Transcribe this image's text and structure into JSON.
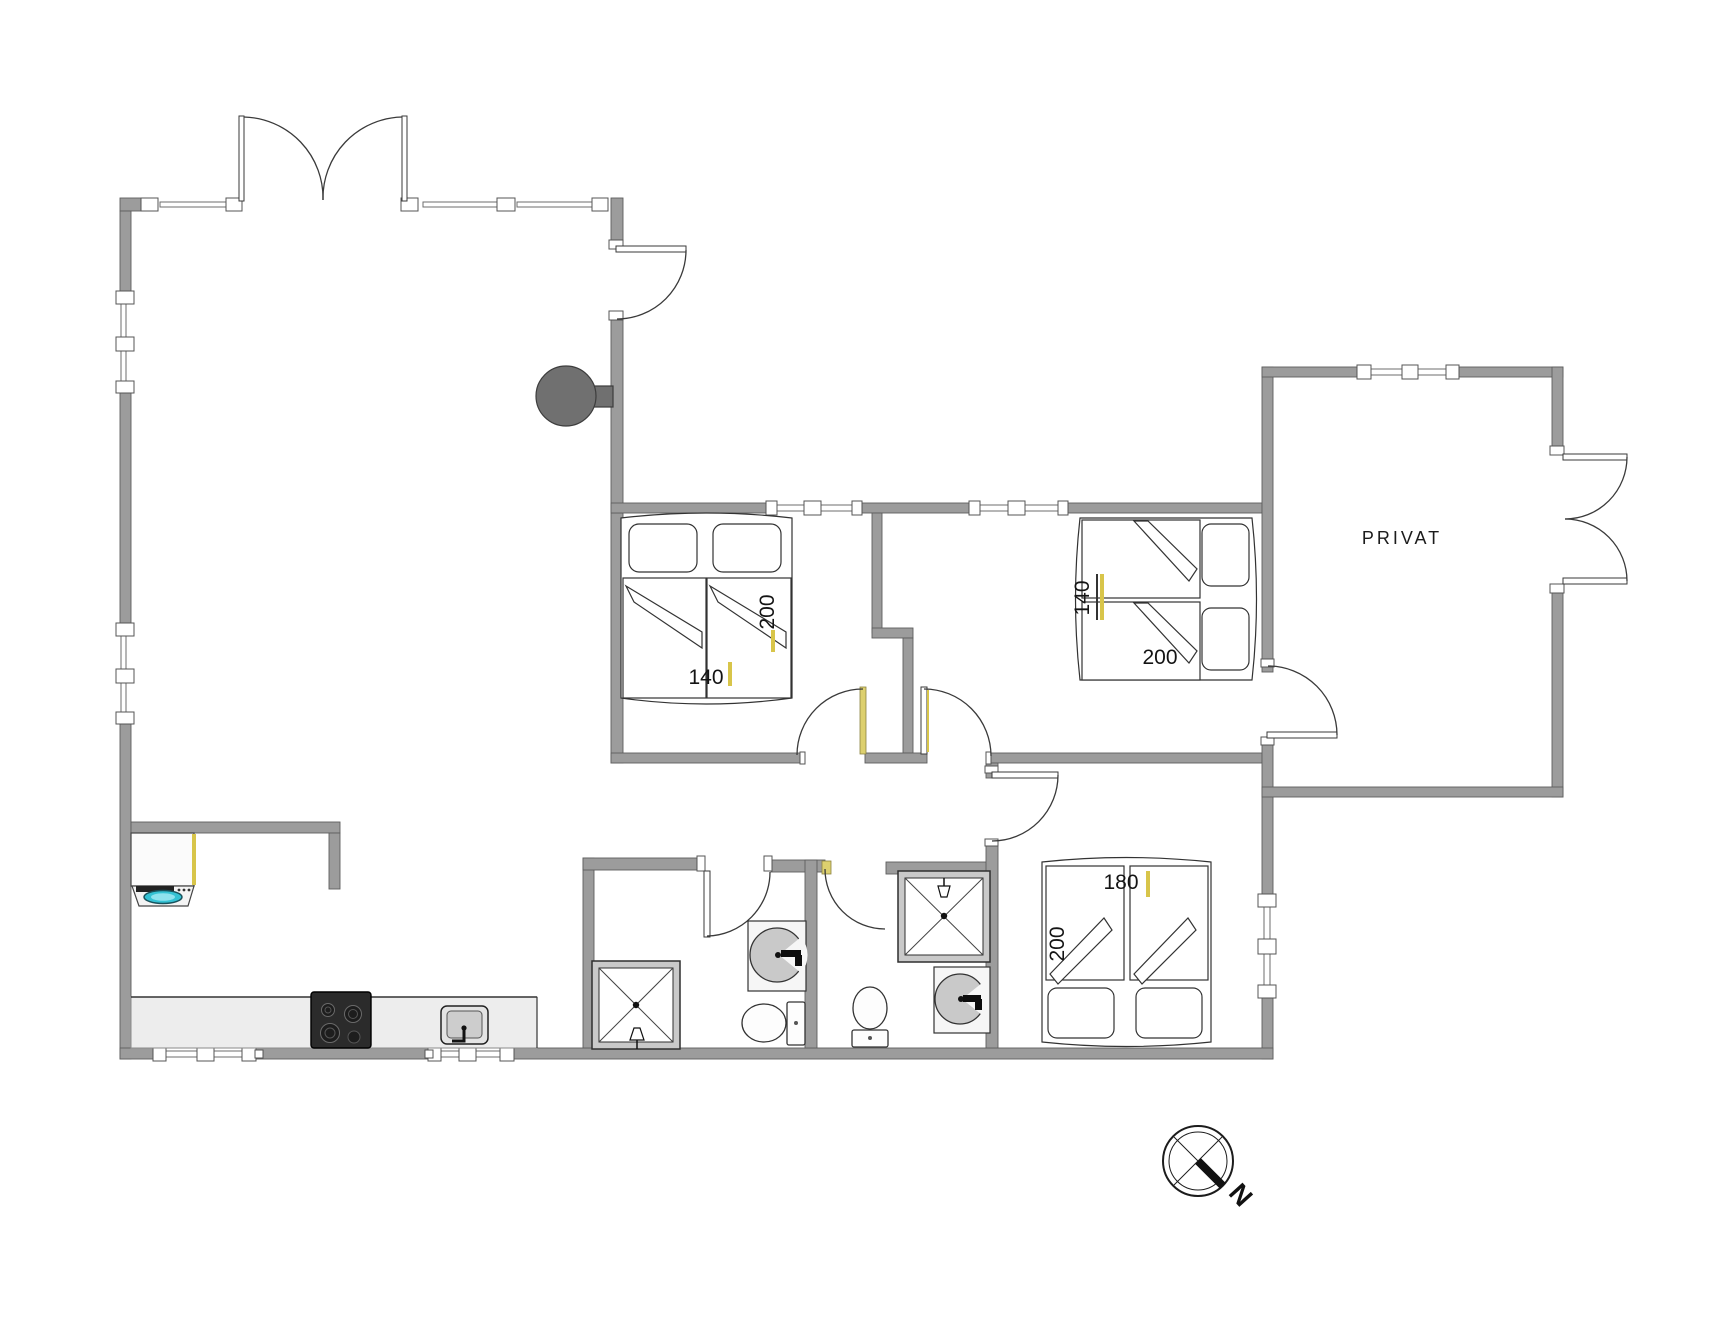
{
  "plan": {
    "private_room_label": "PRIVAT",
    "compass_north_label": "N",
    "bedroom1": {
      "bed_width": "140",
      "bed_length": "200"
    },
    "bedroom2": {
      "bed_width": "140",
      "bed_length": "200"
    },
    "bedroom3": {
      "bed_width": "180",
      "bed_length": "200"
    }
  },
  "colors": {
    "wall_fill": "#9c9c9c",
    "wall_edge": "#5e5e5e",
    "line_dark": "#3a3a3a",
    "accent_yellow": "#d8c54a",
    "fireplace_gray": "#707070",
    "stove_dark": "#2b2b2b",
    "washer_glass_teal": "#35c2d4",
    "counter_light": "#ededed",
    "fixture_gray": "#c9c9c9"
  }
}
